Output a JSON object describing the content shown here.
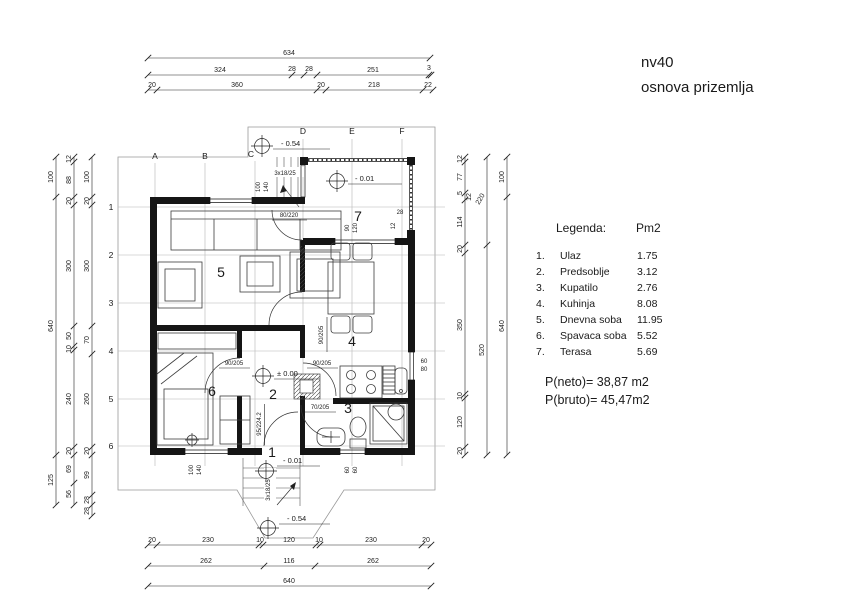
{
  "title": {
    "name": "nv40",
    "subtitle": "osnova prizemlja"
  },
  "legend": {
    "header": "Legenda:",
    "unit": "Pm2",
    "items": [
      {
        "num": "1.",
        "name": "Ulaz",
        "area": "1.75"
      },
      {
        "num": "2.",
        "name": "Predsoblje",
        "area": "3.12"
      },
      {
        "num": "3.",
        "name": "Kupatilo",
        "area": "2.76"
      },
      {
        "num": "4.",
        "name": "Kuhinja",
        "area": "8.08"
      },
      {
        "num": "5.",
        "name": "Dnevna soba",
        "area": "11.95"
      },
      {
        "num": "6.",
        "name": "Spavaca soba",
        "area": "5.52"
      },
      {
        "num": "7.",
        "name": "Terasa",
        "area": "5.69"
      }
    ],
    "neto": "P(neto)=  38,87 m2",
    "bruto": "P(bruto)= 45,47m2"
  },
  "grid": {
    "cols": [
      "A",
      "B",
      "C",
      "D",
      "E",
      "F"
    ],
    "rows": [
      "1",
      "2",
      "3",
      "4",
      "5",
      "6"
    ]
  },
  "dims": {
    "top": {
      "r1": [
        "634"
      ],
      "r2": [
        "324",
        "28",
        "28",
        "251",
        "3"
      ],
      "r3": [
        "20",
        "360",
        "20",
        "218",
        "22"
      ]
    },
    "bottom": {
      "r1": [
        "20",
        "230",
        "10",
        "120",
        "10",
        "230",
        "20"
      ],
      "r2": [
        "262",
        "116",
        "262"
      ],
      "r3": [
        "640"
      ]
    },
    "left": {
      "outer": [
        "100",
        "640",
        "125"
      ],
      "middle": [
        "12",
        "88",
        "20",
        "300",
        "50",
        "10",
        "240",
        "20",
        "69",
        "56"
      ],
      "inner": [
        "100",
        "20",
        "300",
        "70",
        "260",
        "20",
        "99",
        "28",
        "28"
      ]
    },
    "right": {
      "inner": [
        "12",
        "77",
        "5",
        "12",
        "114",
        "20",
        "350",
        "10",
        "120",
        "20"
      ],
      "middle": [
        "220",
        "520"
      ],
      "outer": [
        "100",
        "640"
      ]
    }
  },
  "plan": {
    "room_numbers": [
      "1",
      "2",
      "3",
      "4",
      "5",
      "6",
      "7"
    ],
    "doors": {
      "terrace": "80/220",
      "living": "90/205",
      "bedroom": "90/205",
      "kitchen": "90/205",
      "bathroom": "70/205",
      "entrance": "95/224.2"
    },
    "windows": {
      "top": [
        "100",
        "140"
      ],
      "terrace": [
        "90",
        "120"
      ],
      "bedroom": [
        "100",
        "140"
      ],
      "bathroom": [
        "60",
        "60"
      ],
      "kitchen": [
        "60",
        "80"
      ],
      "pier": [
        "28",
        "12"
      ]
    },
    "stairs": {
      "top": "3x18/25",
      "bottom": "3x18/25"
    },
    "levels": {
      "site_top": "- 0.54",
      "terrace": "- 0.01",
      "hall": "± 0.00",
      "entrance": "- 0.01",
      "site_bottom": "- 0.54"
    }
  }
}
